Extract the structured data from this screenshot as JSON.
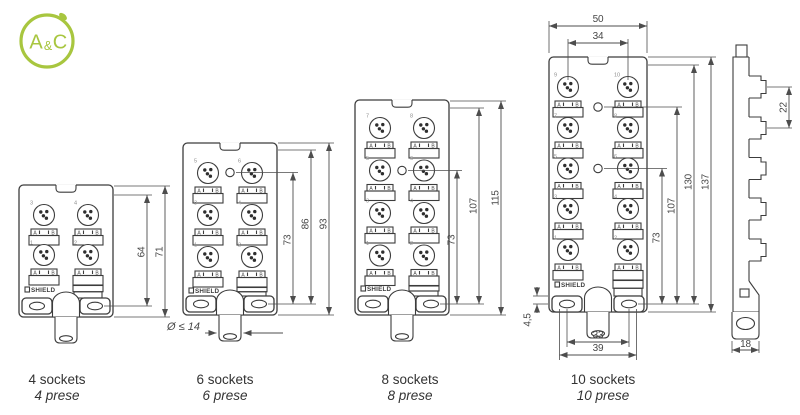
{
  "logo": {
    "letter_a": "A",
    "ampersand": "&",
    "letter_c": "C"
  },
  "blocks": [
    {
      "caption": "4 sockets",
      "caption_alt": "4 prese",
      "shield_label": "SHIELD",
      "led_a": "A",
      "led_b": "B",
      "socket_numbers": [
        "3",
        "4",
        "1",
        "2"
      ],
      "dims": [
        "64",
        "71"
      ]
    },
    {
      "caption": "6 sockets",
      "caption_alt": "6 prese",
      "shield_label": "SHIELD",
      "led_a": "A",
      "led_b": "B",
      "socket_numbers": [
        "5",
        "6",
        "3",
        "4",
        "1",
        "2"
      ],
      "dims": [
        "73",
        "86",
        "93"
      ],
      "gland_note": "Ø ≤ 14"
    },
    {
      "caption": "8 sockets",
      "caption_alt": "8 prese",
      "shield_label": "SHIELD",
      "led_a": "A",
      "led_b": "B",
      "socket_numbers": [
        "7",
        "8",
        "5",
        "6",
        "3",
        "4",
        "1",
        "2"
      ],
      "dims": [
        "73",
        "107",
        "115"
      ]
    },
    {
      "caption": "10 sockets",
      "caption_alt": "10 prese",
      "shield_label": "SHIELD",
      "led_a": "A",
      "led_b": "B",
      "socket_numbers": [
        "9",
        "10",
        "7",
        "8",
        "5",
        "6",
        "3",
        "4",
        "1",
        "2"
      ],
      "dims": [
        "73",
        "107",
        "130",
        "137"
      ],
      "top_dims": {
        "width": "50",
        "socket_spacing": "34"
      },
      "bottom_dims": {
        "hole_spacing": "33",
        "tab_spacing": "39"
      },
      "edge_dim": "4,5"
    }
  ],
  "side_view": {
    "socket_pitch": "22",
    "gland_width": "18"
  },
  "colors": {
    "brand_green": "#a8c63f",
    "line": "#3c3c3c",
    "dimension": "#4d4d4d"
  }
}
